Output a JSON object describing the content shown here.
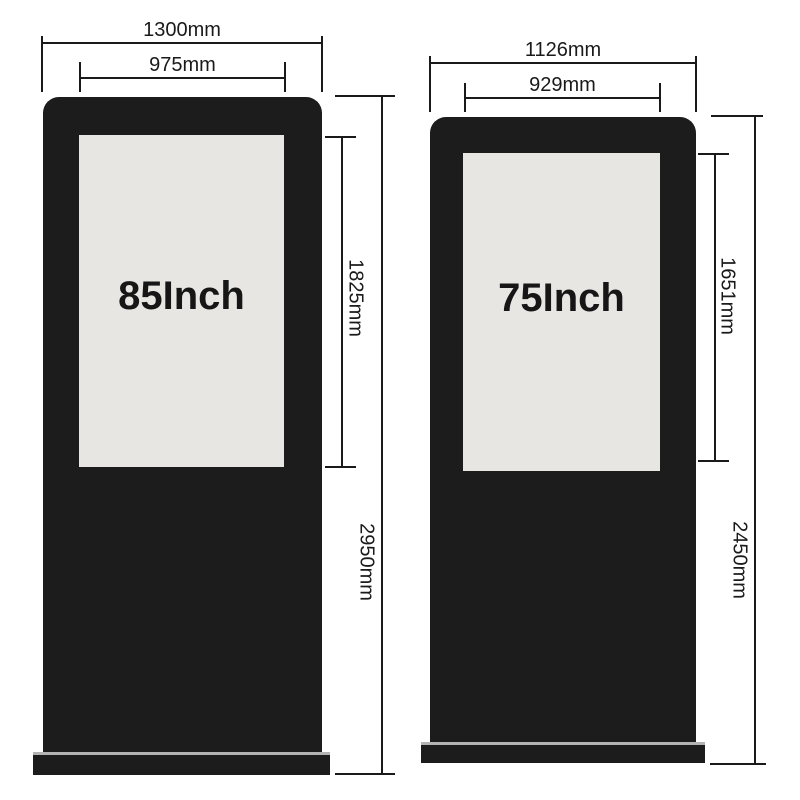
{
  "diagram": {
    "type": "product-dimension-drawing",
    "units": "mm",
    "kiosks": [
      {
        "id": "kiosk-85-inch",
        "screen_label": "85Inch",
        "outer_width": "1300mm",
        "screen_width": "975mm",
        "screen_height": "1825mm",
        "total_height": "2950mm"
      },
      {
        "id": "kiosk-75-inch",
        "screen_label": "75Inch",
        "outer_width": "1126mm",
        "screen_width": "929mm",
        "screen_height": "1651mm",
        "total_height": "2450mm"
      }
    ],
    "colors": {
      "background": "#ffffff",
      "kiosk_body": "#1c1c1c",
      "kiosk_screen": "#e7e6e3",
      "base_trim": "#b3b3b3",
      "dimension_line": "#1a1a1a",
      "label_text": "#161616"
    }
  }
}
